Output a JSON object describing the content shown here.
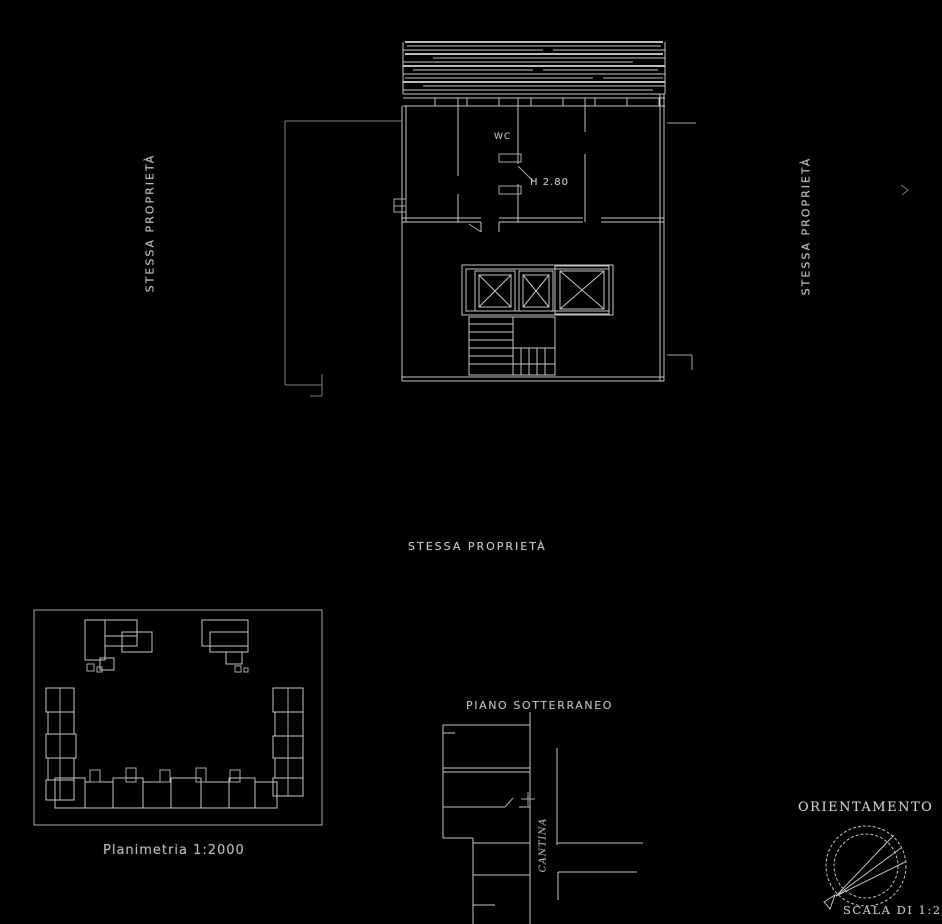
{
  "document": {
    "background": "#000000",
    "line_color": "#c4c4c4",
    "faint_line_color": "#7e7e7e",
    "text_color": "#c6c6c6"
  },
  "main_plan": {
    "left_label": "STESSA PROPRIETÀ",
    "right_label": "STESSA PROPRIETÀ",
    "bottom_label": "STESSA PROPRIETÀ",
    "wc_label": "WC",
    "height_label": "H 2.80"
  },
  "site_plan": {
    "caption": "Planimetria 1:2000"
  },
  "basement_plan": {
    "title": "PIANO SOTTERRANEO",
    "room_label": "CANTINA"
  },
  "orientation": {
    "title": "ORIENTAMENTO",
    "scale_caption": "SCALA DI 1:200",
    "compass_icon": "north-compass-icon"
  }
}
